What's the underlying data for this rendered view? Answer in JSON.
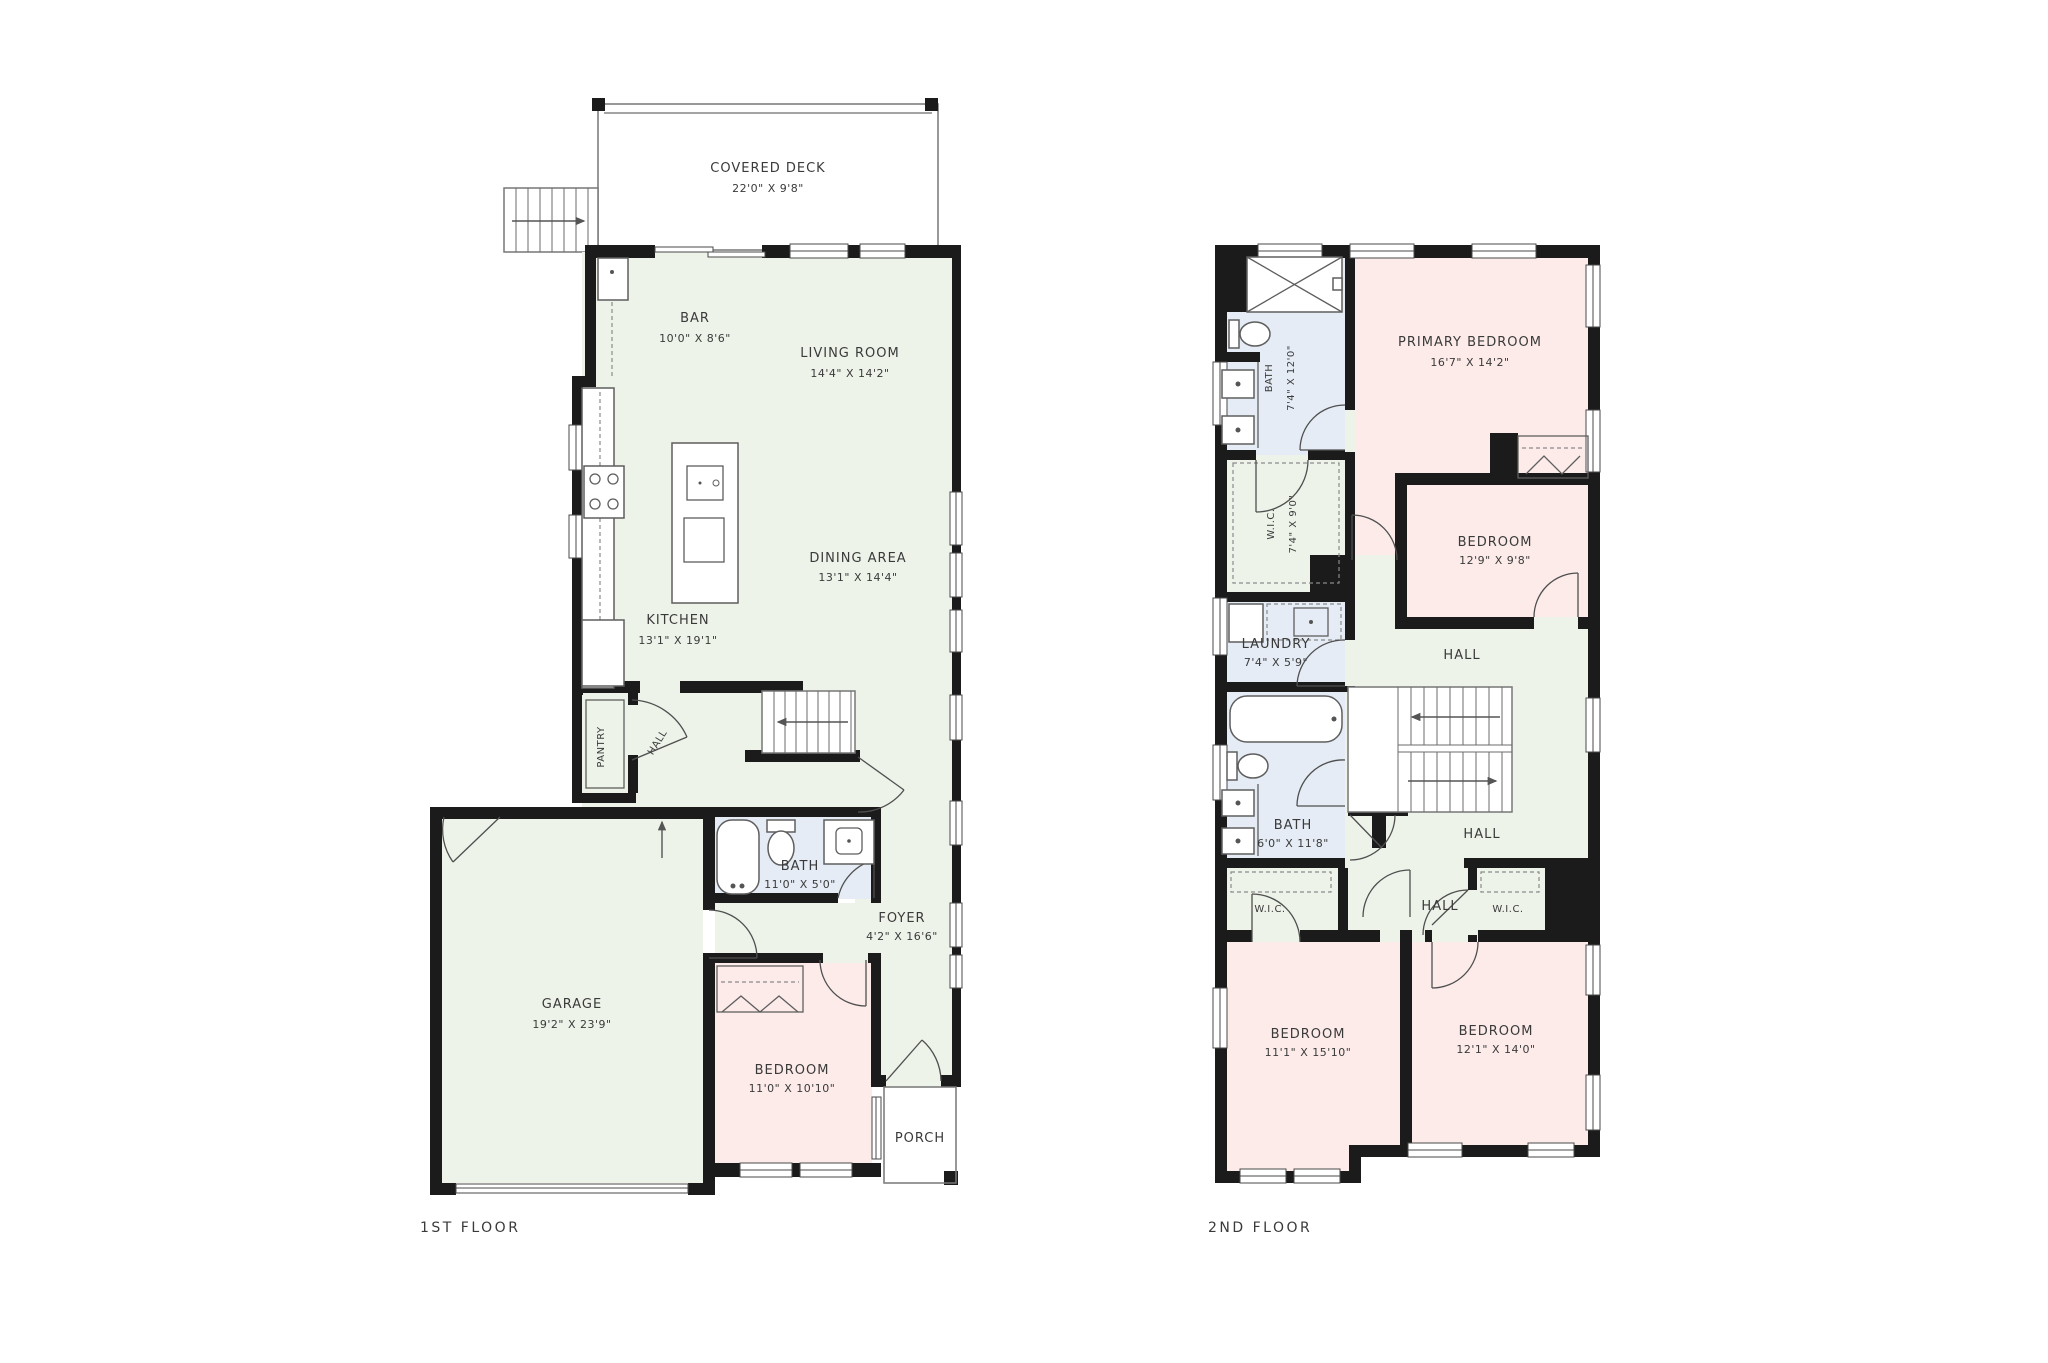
{
  "colors": {
    "wall": "#1b1b1b",
    "room_common_green": "#edf3e9",
    "room_bedroom_pink": "#fcebe9",
    "room_bath_blue": "#e5ecf5",
    "background": "#ffffff",
    "text": "#3a3a3a"
  },
  "floor1": {
    "label": "1ST FLOOR",
    "rooms": {
      "covered_deck": {
        "name": "COVERED DECK",
        "dims": "22'0\" X 9'8\""
      },
      "bar": {
        "name": "BAR",
        "dims": "10'0\" X 8'6\""
      },
      "living_room": {
        "name": "LIVING ROOM",
        "dims": "14'4\" X 14'2\""
      },
      "dining_area": {
        "name": "DINING AREA",
        "dims": "13'1\" X 14'4\""
      },
      "kitchen": {
        "name": "KITCHEN",
        "dims": "13'1\" X 19'1\""
      },
      "pantry": {
        "name": "PANTRY"
      },
      "hall": {
        "name": "HALL"
      },
      "bath": {
        "name": "BATH",
        "dims": "11'0\" X 5'0\""
      },
      "foyer": {
        "name": "FOYER",
        "dims": "4'2\" X 16'6\""
      },
      "garage": {
        "name": "GARAGE",
        "dims": "19'2\" X 23'9\""
      },
      "bedroom": {
        "name": "BEDROOM",
        "dims": "11'0\" X 10'10\""
      },
      "porch": {
        "name": "PORCH"
      }
    }
  },
  "floor2": {
    "label": "2ND FLOOR",
    "rooms": {
      "bath_primary": {
        "name": "BATH",
        "dims": "7'4\" X 12'0\""
      },
      "primary_bedroom": {
        "name": "PRIMARY BEDROOM",
        "dims": "16'7\" X 14'2\""
      },
      "wic_primary": {
        "name": "W.I.C.",
        "dims": "7'4\" X 9'0\""
      },
      "bedroom2": {
        "name": "BEDROOM",
        "dims": "12'9\" X 9'8\""
      },
      "laundry": {
        "name": "LAUNDRY",
        "dims": "7'4\" X 5'9\""
      },
      "hall_upper": {
        "name": "HALL"
      },
      "bath2": {
        "name": "BATH",
        "dims": "6'0\" X 11'8\""
      },
      "hall_lower": {
        "name": "HALL"
      },
      "hall_bottom": {
        "name": "HALL"
      },
      "wic_left": {
        "name": "W.I.C."
      },
      "wic_right": {
        "name": "W.I.C."
      },
      "bedroom3": {
        "name": "BEDROOM",
        "dims": "11'1\" X 15'10\""
      },
      "bedroom4": {
        "name": "BEDROOM",
        "dims": "12'1\" X 14'0\""
      }
    }
  }
}
